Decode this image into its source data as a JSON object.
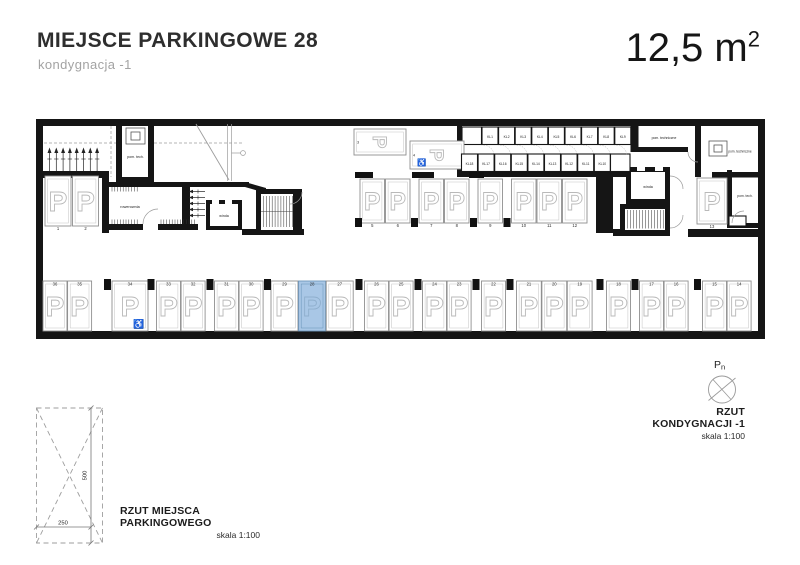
{
  "header": {
    "title": "MIEJSCE PARKINGOWE 28",
    "subtitle": "kondygnacja -1",
    "area_value": "12,5 m",
    "area_exponent": "2"
  },
  "plan": {
    "labels": {
      "pom_tech": "pom. tech.",
      "rowerownia": "rowerownia",
      "winda": "winda",
      "pom_techniczne": "pom. techniczne"
    },
    "highlight": {
      "space": "28",
      "fill": "#a9c7e6",
      "border": "#6d96bb",
      "letter": "#8fafcd"
    },
    "left_spaces": [
      "1",
      "2"
    ],
    "horizontal_spaces": [
      {
        "number": "3",
        "disabled": false
      },
      {
        "number": "4",
        "disabled": true
      }
    ],
    "top_row_groups": [
      [
        "5",
        "6"
      ],
      [
        "7",
        "8"
      ],
      [
        "9"
      ],
      [
        "10",
        "11",
        "12"
      ]
    ],
    "bottom_row_groups": [
      [
        "36",
        "35"
      ],
      [
        "34"
      ],
      [
        "33",
        "32"
      ],
      [
        "31",
        "30"
      ],
      [
        "29",
        "28",
        "27"
      ],
      [
        "26",
        "25"
      ],
      [
        "24",
        "23"
      ],
      [
        "22"
      ],
      [
        "21",
        "20",
        "19"
      ],
      [
        "18"
      ],
      [
        "17",
        "16"
      ],
      [
        "15",
        "14"
      ]
    ],
    "disabled_bottom_space": "34",
    "right_space": "13",
    "lockers_top": [
      "KL1",
      "KL2",
      "KL3",
      "KL4",
      "KL5",
      "KL6",
      "KL7",
      "KL8",
      "KL9"
    ],
    "lockers_bottom": [
      "KL18",
      "KL17",
      "KL16",
      "KL15",
      "KL14",
      "KL13",
      "KL12",
      "KL11",
      "KL10"
    ]
  },
  "detail": {
    "caption": "RZUT MIEJSCA PARKINGOWEGO",
    "scale": "skala 1:100",
    "width_dim": "250",
    "height_dim": "500"
  },
  "north": {
    "label_main": "P",
    "label_sub": "n",
    "caption": "RZUT KONDYGNACJI -1",
    "scale": "skala 1:100"
  }
}
